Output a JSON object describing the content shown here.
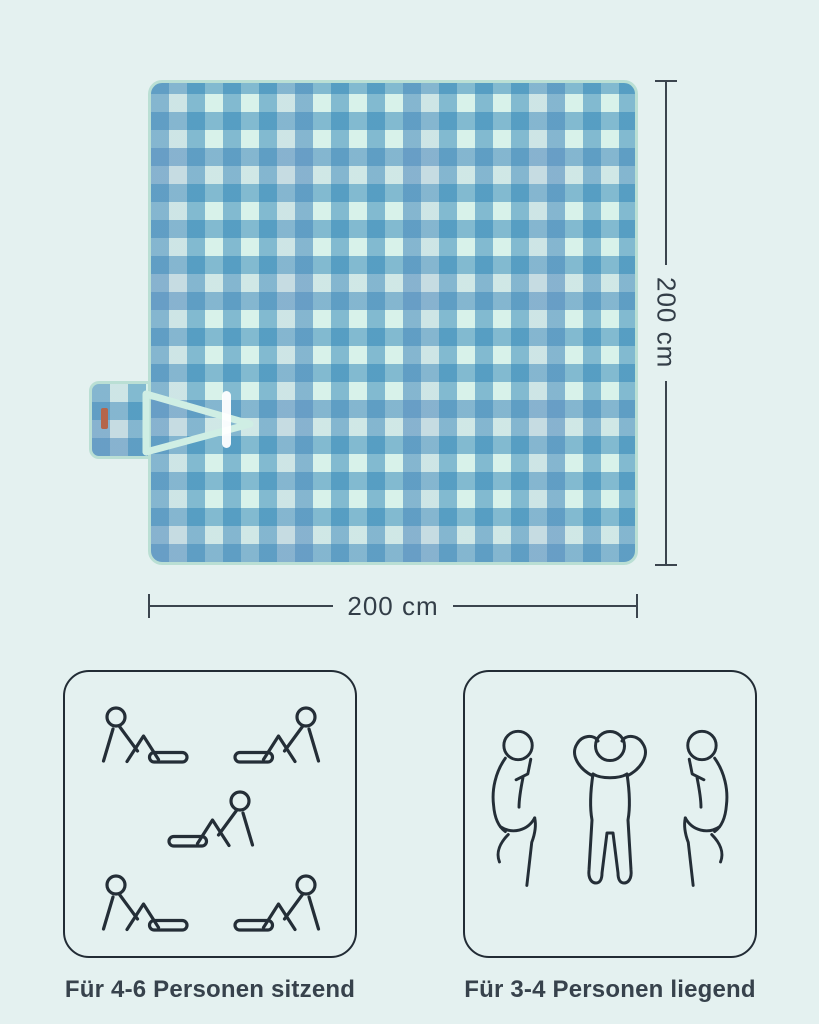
{
  "product_diagram": {
    "blanket": {
      "width_label": "200 cm",
      "height_label": "200 cm",
      "pattern": "blue and mint gingham check",
      "colors": {
        "page_background": "#e4f1f0",
        "blanket_base": "#d8f2ea",
        "check_blue": "#2c82b6",
        "edge_trim": "#badfd4",
        "strap": "#cfeee4",
        "velcro_strip": "#ffffff",
        "brand_tag": "#b5654a",
        "dimension_line": "#3b454e",
        "text": "#37424c"
      }
    },
    "capacity": {
      "sitting": {
        "label": "Für 4-6 Personen sitzend",
        "person_count": 5,
        "pose": "sitzend"
      },
      "lying": {
        "label": "Für 3-4 Personen liegend",
        "person_count": 3,
        "pose": "liegend"
      }
    }
  }
}
